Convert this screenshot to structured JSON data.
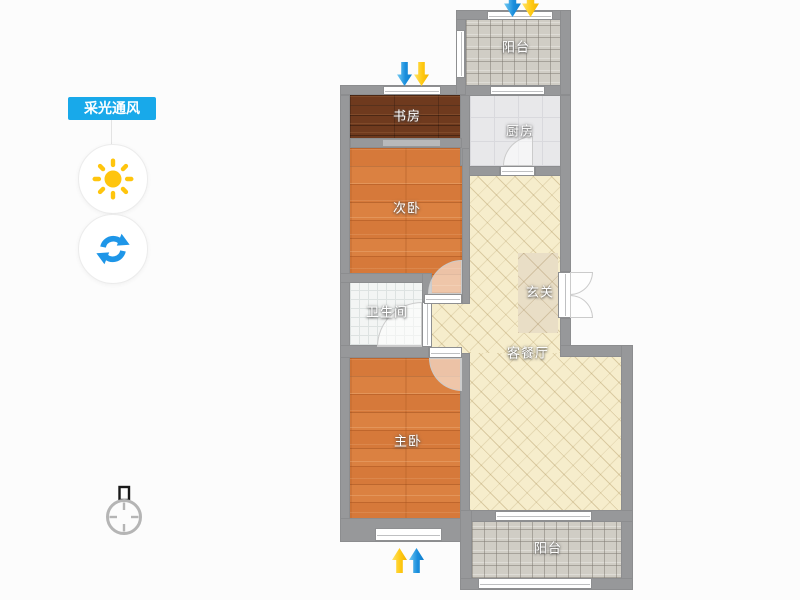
{
  "app": {
    "type": "floor-plan-viewer"
  },
  "sidebar": {
    "toggle_label": "采光通风",
    "toggle_bg": "#18a9ea",
    "buttons": [
      {
        "id": "daylight",
        "icon": "sun-icon",
        "color": "#ffc50d"
      },
      {
        "id": "rotate",
        "icon": "rotate-icon",
        "color": "#1e96e8"
      }
    ]
  },
  "floorplan": {
    "rooms": [
      {
        "id": "balcony-top",
        "label": "阳台",
        "floor": "gray-tile"
      },
      {
        "id": "study",
        "label": "书房",
        "floor": "dark-wood"
      },
      {
        "id": "kitchen",
        "label": "厨房",
        "floor": "light-gray-tile"
      },
      {
        "id": "bedroom-second",
        "label": "次卧",
        "floor": "orange-wood"
      },
      {
        "id": "entry",
        "label": "玄关",
        "floor": "beige-tile"
      },
      {
        "id": "bathroom",
        "label": "卫生间",
        "floor": "white-tile"
      },
      {
        "id": "living-dining",
        "label": "客餐厅",
        "floor": "beige-hatch"
      },
      {
        "id": "bedroom-master",
        "label": "主卧",
        "floor": "orange-wood"
      },
      {
        "id": "balcony-bottom",
        "label": "阳台",
        "floor": "gray-tile"
      }
    ],
    "arrows": {
      "colors": {
        "blue": "#1b8fdd",
        "yellow": "#ffc912"
      },
      "groups": [
        {
          "location": "above-study",
          "direction": "down",
          "order": [
            "blue",
            "yellow"
          ]
        },
        {
          "location": "above-balcony",
          "direction": "down",
          "order": [
            "blue",
            "yellow"
          ]
        },
        {
          "location": "below-master",
          "direction": "up",
          "order": [
            "yellow",
            "blue"
          ]
        }
      ]
    },
    "wall_color": "#97989a",
    "compass": {
      "shows": "north-indicator"
    }
  }
}
